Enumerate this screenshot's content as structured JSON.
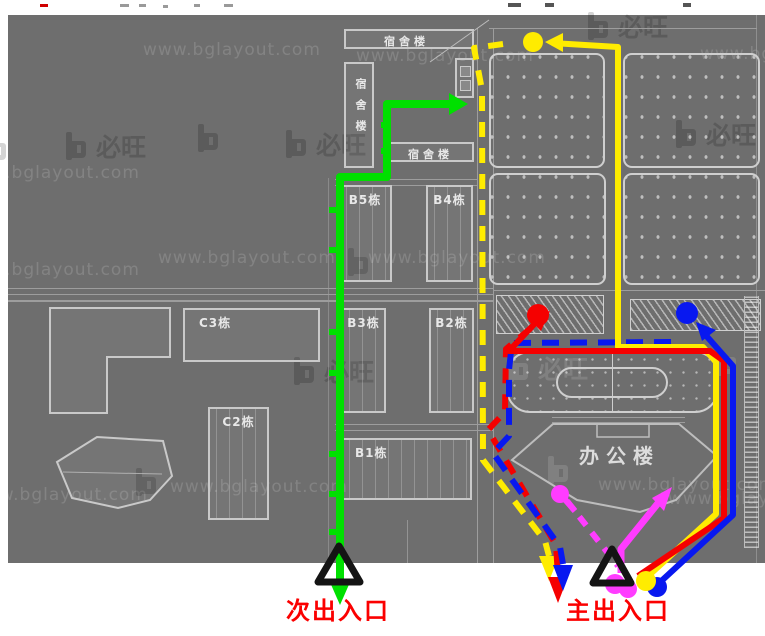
{
  "map": {
    "buildings": {
      "dorm_top": "宿舍楼",
      "dorm_left": "宿舍楼",
      "dorm_mid": "宿舍楼",
      "b5": "B5栋",
      "b4": "B4栋",
      "b3": "B3栋",
      "b2": "B2栋",
      "b1": "B1栋",
      "d2": "D2栋",
      "c3": "C3栋",
      "c2": "C2栋",
      "d1": "D1栋",
      "office": "办公楼"
    },
    "entrances": {
      "secondary": "次出入口",
      "main": "主出入口"
    },
    "watermark": {
      "url": "www.bglayout.com",
      "brand": "必旺"
    },
    "colors": {
      "map_bg": "#6e6e6e",
      "building_line": "#c9c9c9",
      "road_line": "#9d9d9d",
      "route_green": "#00e000",
      "route_yellow": "#ffec00",
      "route_red": "#f50000",
      "route_blue": "#0818f0",
      "route_magenta": "#ff3cff",
      "marker_black": "#141414",
      "entrance_label_red": "#fb0000"
    }
  }
}
